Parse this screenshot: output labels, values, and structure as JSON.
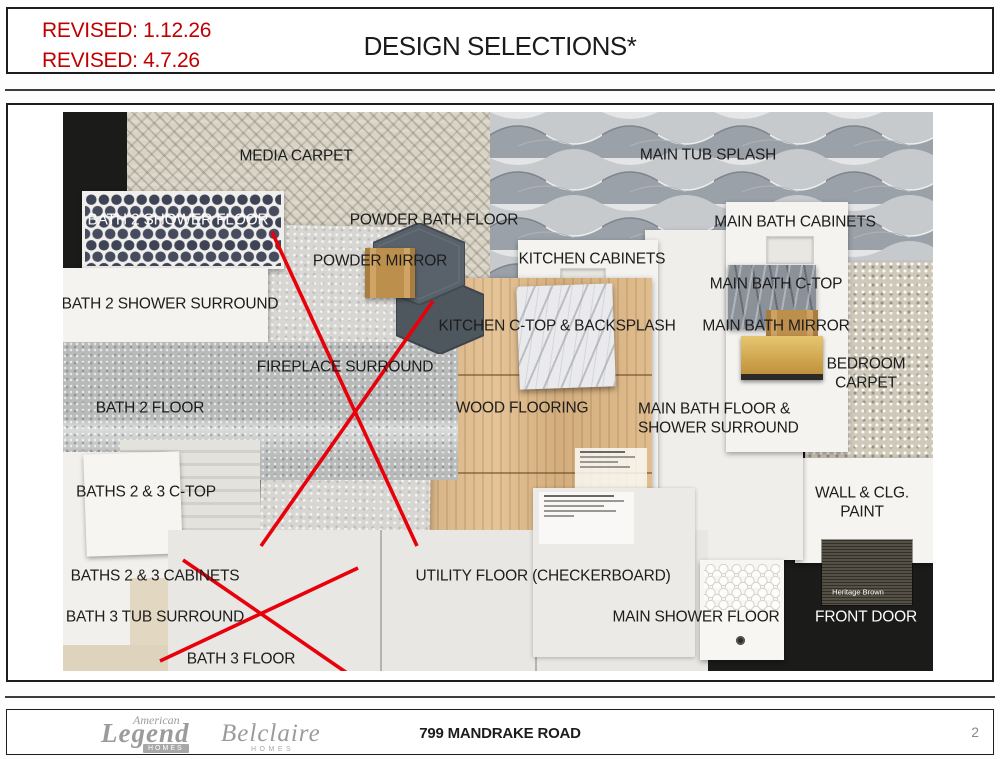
{
  "header": {
    "revised_1": "REVISED: 1.12.26",
    "revised_2": "REVISED: 4.7.26",
    "title": "DESIGN SELECTIONS*"
  },
  "board": {
    "labels": {
      "media_carpet": "MEDIA CARPET",
      "main_tub_splash": "MAIN TUB SPLASH",
      "bath2_shower_floor": "BATH 2 SHOWER FLOOR",
      "powder_bath_floor": "POWDER BATH FLOOR",
      "powder_mirror": "POWDER MIRROR",
      "kitchen_cabinets": "KITCHEN CABINETS",
      "main_bath_cabinets": "MAIN BATH CABINETS",
      "bath2_shower_surround": "BATH 2 SHOWER SURROUND",
      "main_bath_ctop": "MAIN BATH C-TOP",
      "kitchen_ctop_backsplash": "KITCHEN C-TOP & BACKSPLASH",
      "main_bath_mirror": "MAIN BATH MIRROR",
      "bedroom_carpet": "BEDROOM CARPET",
      "fireplace_surround": "FIREPLACE SURROUND",
      "bath2_floor": "BATH 2 FLOOR",
      "wood_flooring": "WOOD FLOORING",
      "main_bath_floor_shower": "MAIN BATH FLOOR & SHOWER SURROUND",
      "baths23_ctop": "BATHS 2 & 3 C-TOP",
      "wall_clg_paint": "WALL & CLG. PAINT",
      "baths23_cabinets": "BATHS 2 & 3 CABINETS",
      "bath3_tub_surround": "BATH 3 TUB SURROUND",
      "utility_floor": "UTILITY FLOOR (CHECKERBOARD)",
      "bath3_floor": "BATH 3 FLOOR",
      "main_shower_floor": "MAIN SHOWER FLOOR",
      "front_door": "FRONT DOOR",
      "front_door_swatch": "Heritage Brown"
    },
    "colors": {
      "strikethrough_red": "#e8000b",
      "revised_red": "#c00000"
    }
  },
  "footer": {
    "logo": {
      "american": "American",
      "legend": "Legend",
      "homes": "HOMES",
      "belclaire": "Belclaire",
      "belclaire_homes": "HOMES"
    },
    "address": "799 MANDRAKE ROAD",
    "page_number": "2"
  }
}
